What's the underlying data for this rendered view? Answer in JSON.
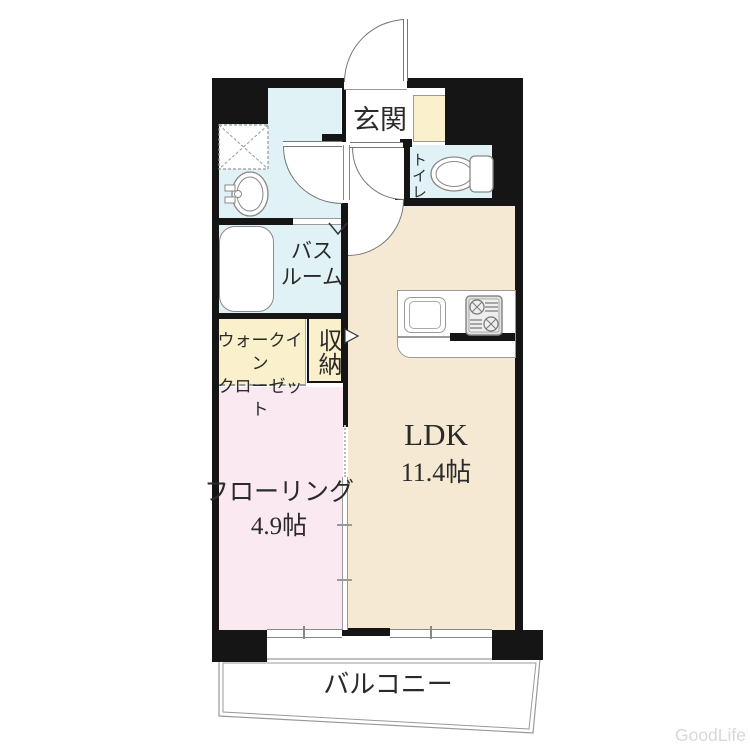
{
  "title": "apartment-floor-plan",
  "rooms": {
    "genkan": {
      "label": "玄関"
    },
    "toilet": {
      "label": "トイレ"
    },
    "bathroom": {
      "label_line1": "バス",
      "label_line2": "ルーム"
    },
    "walk_in_closet": {
      "label_line1": "ウォークイン",
      "label_line2": "クローゼット"
    },
    "storage": {
      "label": "収納"
    },
    "ldk": {
      "label": "LDK",
      "size": "11.4帖"
    },
    "flooring": {
      "label": "フローリング",
      "size": "4.9帖"
    },
    "balcony": {
      "label": "バルコニー"
    }
  },
  "watermark": "GoodLife",
  "colors": {
    "wall": "#151515",
    "water_rooms": "#e1f2f6",
    "closet_cream": "#faf0cb",
    "ldk_beige": "#f6e9d3",
    "flooring_pink": "#fbe9f2",
    "balcony_white": "#ffffff",
    "watermark_gray": "#d8d8d8"
  }
}
